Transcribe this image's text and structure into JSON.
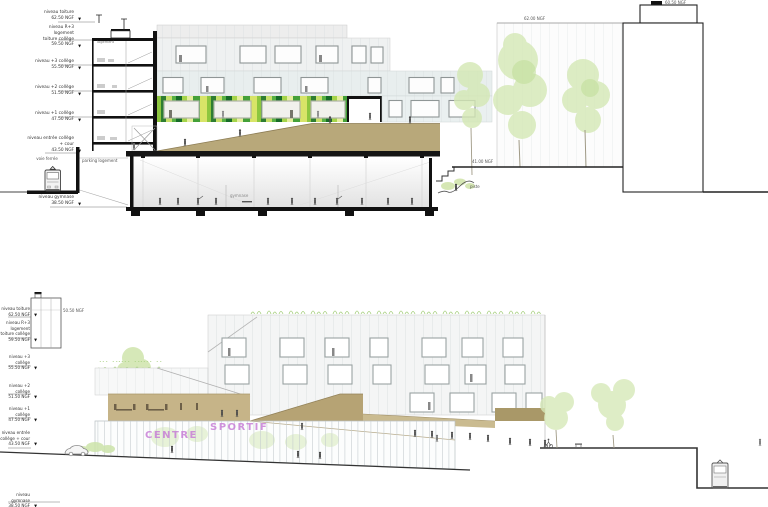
{
  "icons": {
    "level_marker": "▼"
  },
  "colors": {
    "ink": "#111111",
    "tan_ramp": "#b8a87a",
    "tan_band": "#c6b488",
    "purple_signage": "#c678d6",
    "greens": [
      "#d8e468",
      "#8dc63f",
      "#2e7d32",
      "#c8e06a",
      "#56b044",
      "#176b28",
      "#a5d44a",
      "#e6ef9e",
      "#44a038"
    ],
    "foliage": "#cfe5ac"
  },
  "top": {
    "levels": [
      {
        "text": "niveau toiture\n62.50 NGF"
      },
      {
        "text": "niveau R+3\nlogement\ntoiture collège\n59.50 NGF"
      },
      {
        "text": "niveau +3 collège\n55.50 NGF"
      },
      {
        "text": "niveau +2 collège\n51.50 NGF"
      },
      {
        "text": "niveau +1 collège\n47.50 NGF"
      },
      {
        "text": "niveau entrée collège\n+ cour\n43.50 NGF"
      },
      {
        "text": "niveau gymnase\n38.50 NGF"
      }
    ],
    "annotations": {
      "voie_ferree": "voie ferrée",
      "parking": "parking logement",
      "gymnase": "gymnase",
      "logement": "logement",
      "ngf_6200": "62.00 NGF",
      "ngf_6050": "60.50 NGF",
      "ngf_4100": "41.00 NGF",
      "piste": "piste"
    }
  },
  "bottom": {
    "levels": [
      {
        "text": "niveau toiture\n62.50 NGF"
      },
      {
        "text": "niveau R+3\nlogement\ntoiture collège\n59.50 NGF"
      },
      {
        "text": "niveau +3 collège\n55.50 NGF"
      },
      {
        "text": "niveau +2 collège\n51.50 NGF"
      },
      {
        "text": "niveau +1 collège\n47.50 NGF"
      },
      {
        "text": "niveau entrée\ncollège + cour\n43.50 NGF"
      },
      {
        "text": "niveau gymnase\n38.50 NGF"
      }
    ],
    "annotations": {
      "ngf_5050": "50.50 NGF",
      "centre": "CENTRE",
      "sportif": "SPORTIF"
    }
  }
}
